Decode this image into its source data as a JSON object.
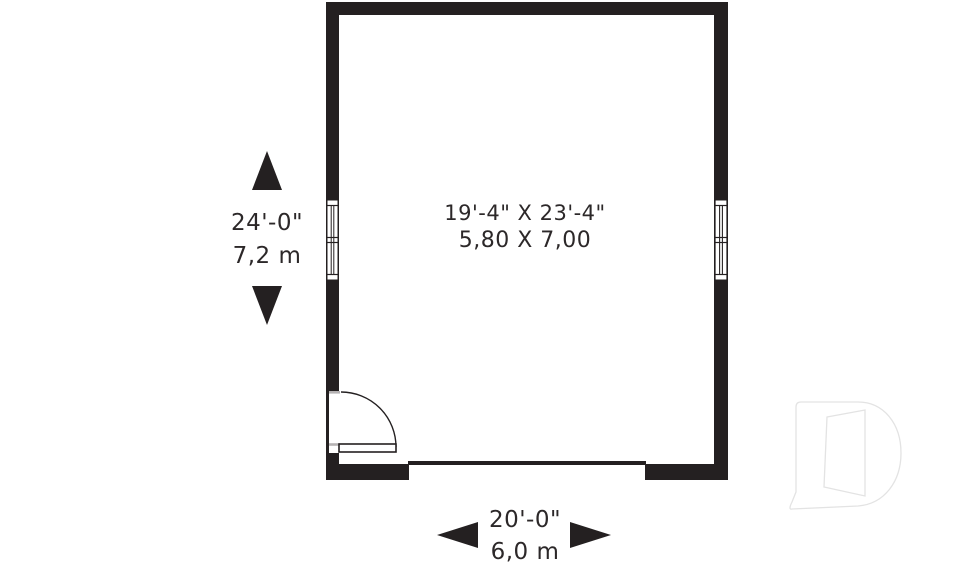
{
  "plan": {
    "room_label": {
      "line1": "19'-4\" X 23'-4\"",
      "line2": "5,80 X 7,00"
    },
    "dimension_vertical": {
      "feet": "24'-0\"",
      "metric": "7,2 m"
    },
    "dimension_horizontal": {
      "feet": "20'-0\"",
      "metric": "6,0 m"
    }
  },
  "colors": {
    "ink": "#242021",
    "text": "#2c2829",
    "sill_gray": "#b5b2b3",
    "watermark": "#e3e3e3",
    "background": "#ffffff"
  },
  "icons": {
    "arrow-up-icon": "▲",
    "arrow-down-icon": "▼",
    "arrow-left-icon": "◀",
    "arrow-right-icon": "▶",
    "door-swing-icon": "quarter-circle-arc",
    "window-icon": "plan-window-symbol",
    "builder-logo-watermark": "stylized-D-outline"
  }
}
